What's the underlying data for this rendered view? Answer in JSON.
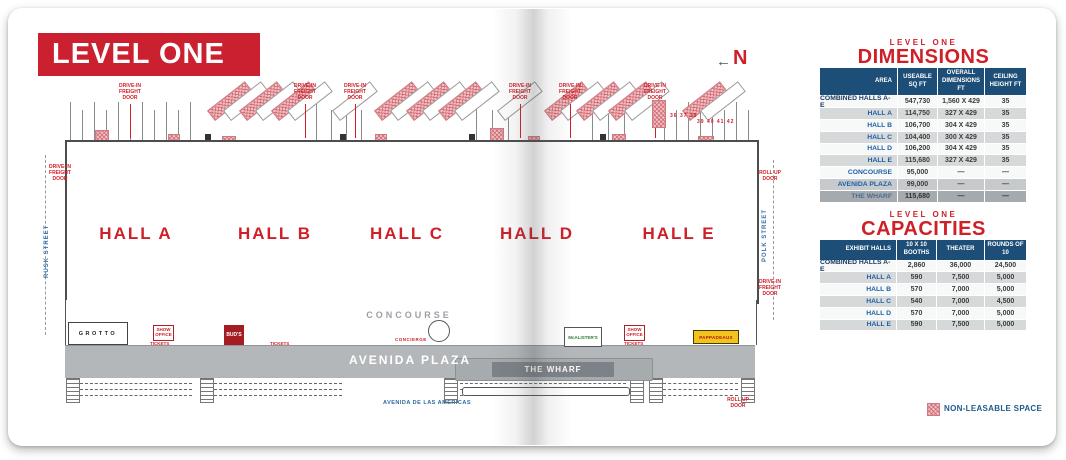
{
  "page": {
    "level_title": "LEVEL ONE",
    "north_arrow": "←",
    "north_label": "N",
    "legend_label": "NON-LEASABLE SPACE"
  },
  "floor_plan": {
    "hall_labels": [
      "HALL A",
      "HALL B",
      "HALL C",
      "HALL D",
      "HALL E"
    ],
    "concourse": "CONCOURSE",
    "concierge": "CONCIERGE",
    "avenida_plaza": "AVENIDA PLAZA",
    "the_wharf": "THE WHARF",
    "streets": {
      "left": "RUSK STREET",
      "right": "POLK STREET",
      "bottom": "AVENIDA DE LAS AMERICAS"
    },
    "labels": {
      "drive_in_freight_door": "DRIVE-IN FREIGHT DOOR",
      "roll_up_door": "ROLL UP DOOR",
      "show_office": "SHOW OFFICE",
      "tickets": "TICKETS"
    },
    "venues": {
      "grotto": "GROTTO",
      "buds": "BUD'S",
      "mcalisters": "McALISTER'S",
      "pappadeaux": "PAPPADEAUX"
    },
    "dock_numbers_a": "36 37 38",
    "dock_numbers_b": "39 40 41 42"
  },
  "dimensions_table": {
    "eyebrow": "LEVEL ONE",
    "title": "DIMENSIONS",
    "columns": [
      "AREA",
      "USEABLE SQ FT",
      "OVERALL DIMENSIONS FT",
      "CEILING HEIGHT FT"
    ],
    "rows": [
      {
        "area": "COMBINED HALLS A-E",
        "useable": "547,730",
        "overall": "1,560 X 429",
        "ceiling": "35",
        "tone": "a",
        "strong": true
      },
      {
        "area": "HALL A",
        "useable": "114,750",
        "overall": "327 X 429",
        "ceiling": "35",
        "tone": "b"
      },
      {
        "area": "HALL B",
        "useable": "106,700",
        "overall": "304 X 429",
        "ceiling": "35",
        "tone": "a"
      },
      {
        "area": "HALL C",
        "useable": "104,400",
        "overall": "300 X 429",
        "ceiling": "35",
        "tone": "b"
      },
      {
        "area": "HALL D",
        "useable": "106,200",
        "overall": "304 X 429",
        "ceiling": "35",
        "tone": "a"
      },
      {
        "area": "HALL E",
        "useable": "115,680",
        "overall": "327 X 429",
        "ceiling": "35",
        "tone": "b"
      },
      {
        "area": "CONCOURSE",
        "useable": "95,000",
        "overall": "—",
        "ceiling": "—",
        "tone": "a"
      },
      {
        "area": "AVENIDA PLAZA",
        "useable": "99,000",
        "overall": "—",
        "ceiling": "—",
        "tone": "c"
      },
      {
        "area": "THE WHARF",
        "useable": "115,680",
        "overall": "—",
        "ceiling": "—",
        "tone": "dark"
      }
    ]
  },
  "capacities_table": {
    "eyebrow": "LEVEL ONE",
    "title": "CAPACITIES",
    "columns": [
      "EXHIBIT HALLS",
      "10 X 10 BOOTHS",
      "THEATER",
      "ROUNDS OF 10"
    ],
    "rows": [
      {
        "hall": "COMBINED HALLS A-E",
        "booths": "2,860",
        "theater": "36,000",
        "rounds": "24,500",
        "tone": "a",
        "strong": true
      },
      {
        "hall": "HALL A",
        "booths": "590",
        "theater": "7,500",
        "rounds": "5,000",
        "tone": "b"
      },
      {
        "hall": "HALL B",
        "booths": "570",
        "theater": "7,000",
        "rounds": "5,000",
        "tone": "a"
      },
      {
        "hall": "HALL C",
        "booths": "540",
        "theater": "7,000",
        "rounds": "4,500",
        "tone": "b"
      },
      {
        "hall": "HALL D",
        "booths": "570",
        "theater": "7,000",
        "rounds": "5,000",
        "tone": "a"
      },
      {
        "hall": "HALL E",
        "booths": "590",
        "theater": "7,500",
        "rounds": "5,000",
        "tone": "b"
      }
    ]
  }
}
